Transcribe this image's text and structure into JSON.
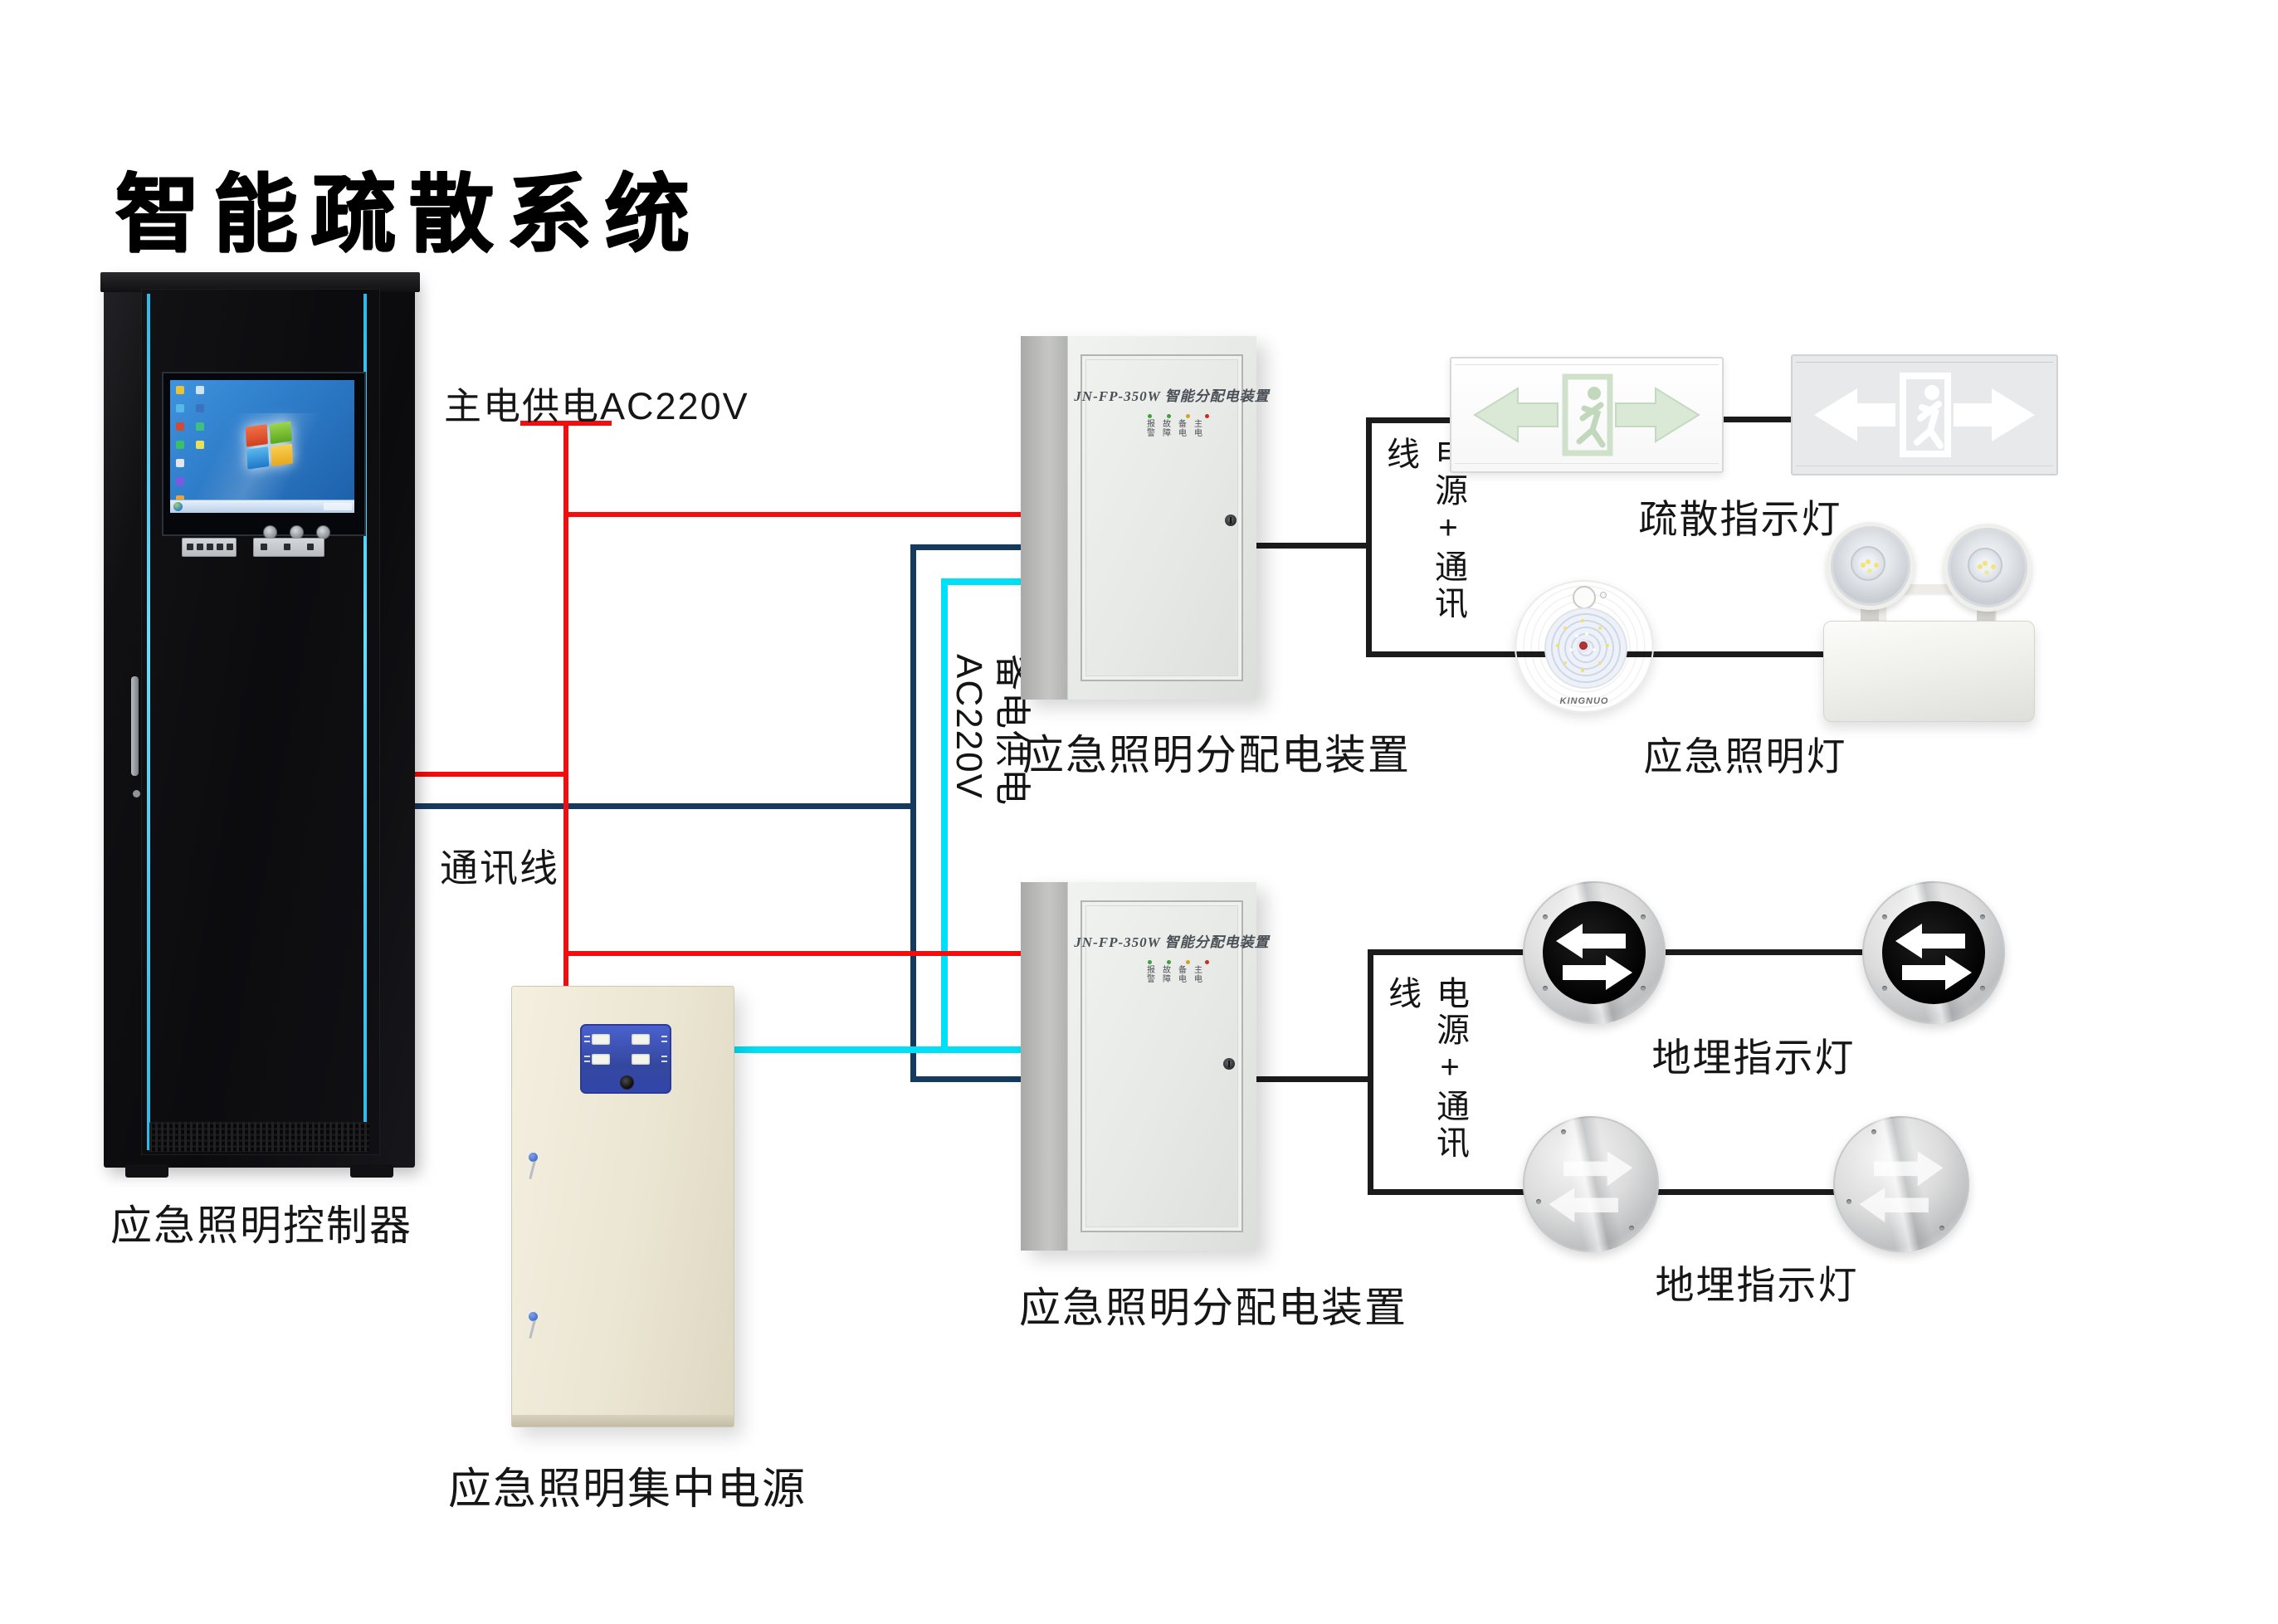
{
  "title": "智能疏散系统图",
  "colors": {
    "main_power_red": "#f30d0d",
    "comm_navy": "#16395f",
    "backup_cyan": "#00dff5",
    "connector_black": "#1b1b1b",
    "cabinet_accent_cyan": "#45cdf5"
  },
  "wiring": {
    "main_power_label": "主电供电AC220V",
    "comm_label": "通讯线",
    "backup_label": "备电供电AC220V"
  },
  "controller": {
    "label": "应急照明控制器"
  },
  "central_power": {
    "label": "应急照明集中电源"
  },
  "dist_box_1": {
    "label": "应急照明分配电装置",
    "model": "JN-FP-350W 智能分配电装置",
    "led_row1": "报故备主",
    "led_row2": "警障电电",
    "bracket_label": "电源+通讯线"
  },
  "dist_box_2": {
    "label": "应急照明分配电装置",
    "model": "JN-FP-350W 智能分配电装置",
    "led_row1": "报故备主",
    "led_row2": "警障电电",
    "bracket_label": "电源+通讯线"
  },
  "devices": {
    "evac_sign_label": "疏散指示灯",
    "emergency_lamp_label": "应急照明灯",
    "emergency_lamp_brand": "KINGNUO",
    "ground_sign_1_label": "地埋指示灯",
    "ground_sign_2_label": "地埋指示灯"
  }
}
